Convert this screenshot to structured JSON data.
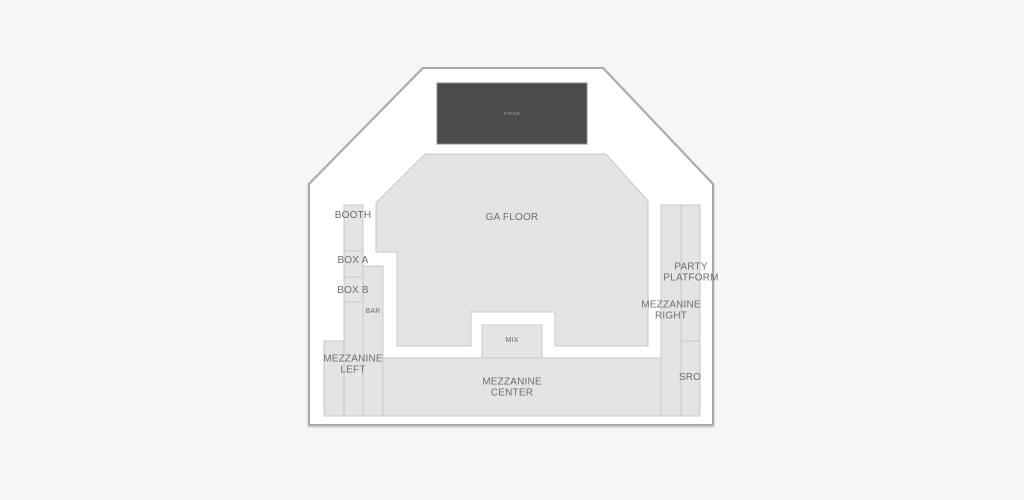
{
  "title": "Venue seating chart",
  "colors": {
    "background": "#f7f6f4",
    "venue_fill": "#ffffff",
    "venue_stroke": "#a9a9a9",
    "section_fill": "#e4e4e5",
    "section_stroke": "#c8c8c8",
    "stage_fill": "#4b4b4b",
    "stage_stroke": "#8d8d8d",
    "label_color": "#6d6d6d",
    "stage_label_color": "#ababab"
  },
  "sections": {
    "stage": {
      "label": "STAGE"
    },
    "ga_floor": {
      "label": "GA FLOOR"
    },
    "booth": {
      "label": "BOOTH"
    },
    "box_a": {
      "label": "BOX A"
    },
    "box_b": {
      "label": "BOX B"
    },
    "bar": {
      "label": "BAR"
    },
    "mix": {
      "label": "MIX"
    },
    "mezzanine_left": {
      "label": "MEZZANINE\nLEFT"
    },
    "mezzanine_center": {
      "label": "MEZZANINE\nCENTER"
    },
    "mezzanine_right": {
      "label": "MEZZANINE\nRIGHT"
    },
    "party_platform": {
      "label": "PARTY\nPLATFORM"
    },
    "sro": {
      "label": "SRO"
    }
  }
}
